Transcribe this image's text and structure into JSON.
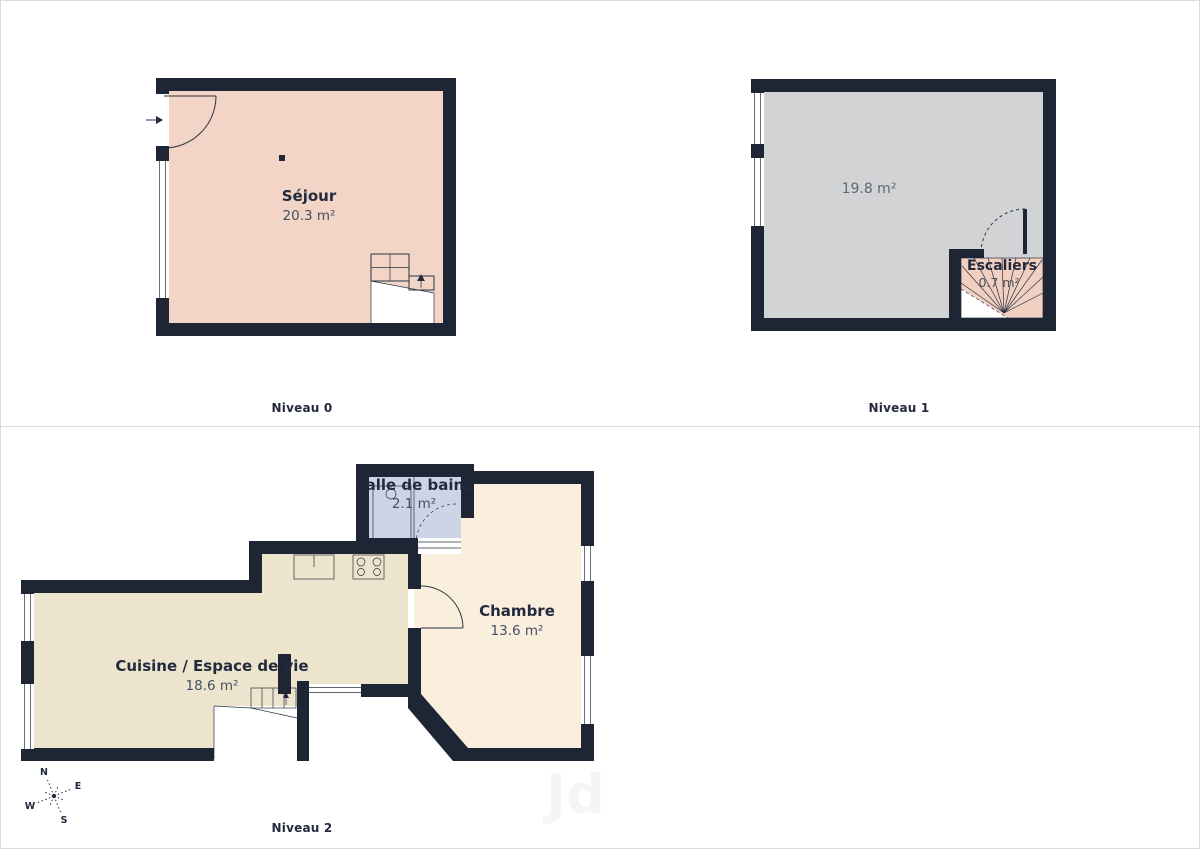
{
  "page": {
    "watermark": "Jd"
  },
  "colors": {
    "wall": "#1e2534",
    "line": "#2a3342",
    "sejour_floor": "#f2d5c6",
    "niveau1_floor": "#d2d3d4",
    "stairs_fill": "#f1d0c1",
    "cuisine_floor": "#ece4cc",
    "chambre_floor": "#faeedc",
    "bathroom_floor": "#ccd5e5",
    "label_text": "#232a3e",
    "area_text": "#455062",
    "area_text_gray": "#5f6876",
    "divider": "#d9dce1"
  },
  "levels": [
    {
      "name": "Niveau 0",
      "rooms": [
        {
          "label": "Séjour",
          "area": "20.3 m²"
        }
      ]
    },
    {
      "name": "Niveau 1",
      "rooms": [
        {
          "label": "",
          "area": "19.8 m²"
        },
        {
          "label": "Escaliers",
          "area": "0.7 m²"
        }
      ]
    },
    {
      "name": "Niveau 2",
      "rooms": [
        {
          "label": "Salle de bains",
          "area": "2.1 m²"
        },
        {
          "label": "Cuisine / Espace de vie",
          "area": "18.6 m²"
        },
        {
          "label": "Chambre",
          "area": "13.6 m²"
        }
      ]
    }
  ],
  "compass": {
    "n": "N",
    "e": "E",
    "s": "S",
    "w": "W"
  }
}
